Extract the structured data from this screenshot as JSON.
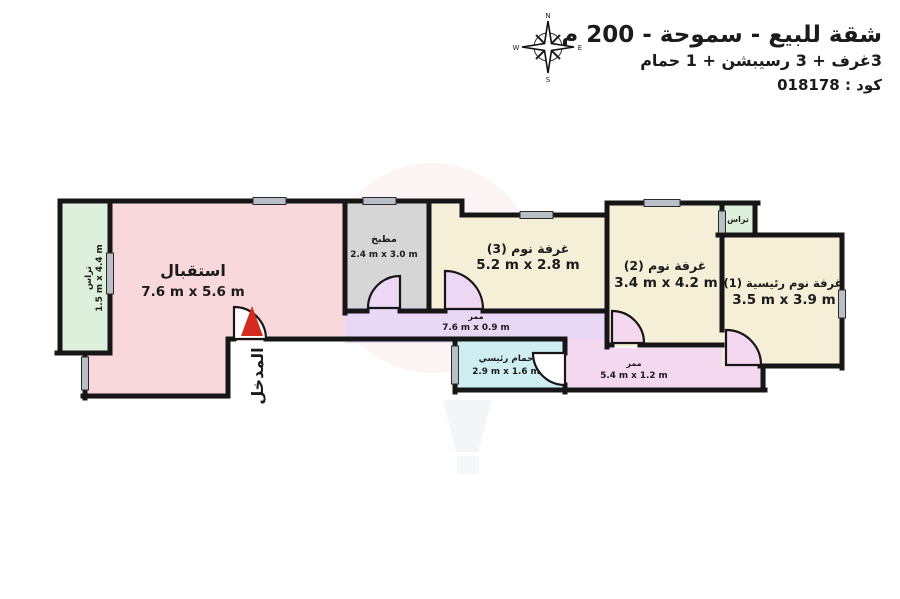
{
  "header": {
    "title": "شقة للبيع - سموحة - 200 م",
    "subtitle": "3غرف + 3 رسيبشن + 1 حمام",
    "code": "كود : 018178"
  },
  "compass": {
    "n": "N",
    "e": "E",
    "s": "S",
    "w": "W"
  },
  "entrance": {
    "label": "المدخل"
  },
  "rooms": [
    {
      "id": "reception",
      "name": "استقبال",
      "dims": "7.6 m x 5.6 m",
      "color": "#f8d8da"
    },
    {
      "id": "terrace-left",
      "name": "تراس",
      "dims": "1.5 m x 4.4 m",
      "color": "#dcf0dc"
    },
    {
      "id": "kitchen",
      "name": "مطبخ",
      "dims": "2.4 m x 3.0 m",
      "color": "#d6d6d6"
    },
    {
      "id": "bedroom-3",
      "name": "غرفة نوم (3)",
      "dims": "5.2 m x 2.8 m",
      "color": "#f5efd8"
    },
    {
      "id": "corridor-upper",
      "name": "ممر",
      "dims": "7.6 m x 0.9 m",
      "color": "#e9d8f5"
    },
    {
      "id": "bathroom",
      "name": "حمام رئيسي",
      "dims": "2.9 m x 1.6 m",
      "color": "#cfeef2"
    },
    {
      "id": "corridor-lower",
      "name": "ممر",
      "dims": "5.4 m x 1.2 m",
      "color": "#f3d8f0"
    },
    {
      "id": "bedroom-2",
      "name": "غرفة نوم (2)",
      "dims": "3.4 m x 4.2 m",
      "color": "#f5efd8"
    },
    {
      "id": "terrace-right",
      "name": "تراس",
      "dims": "",
      "color": "#dcf0dc"
    },
    {
      "id": "master-bedroom",
      "name": "غرفة نوم رئيسية (1)",
      "dims": "3.5 m x 3.9 m",
      "color": "#f5efd8"
    }
  ],
  "colors": {
    "wall": "#161616",
    "window": "#b9bfc6",
    "entrance_arrow": "#d42a20",
    "door_swing_purple": "#eed7f4",
    "door_swing_pink": "#f4d8f0"
  }
}
